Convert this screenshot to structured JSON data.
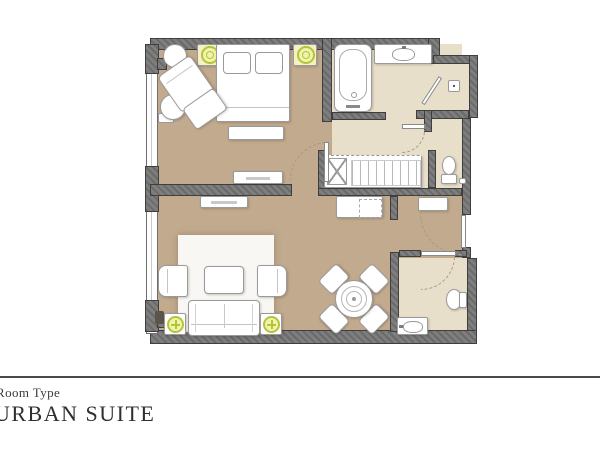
{
  "footer": {
    "label": "Room Type",
    "room_name": "URBAN SUITE"
  },
  "palette": {
    "wall": "#767676",
    "wall_edge": "#3e3e3e",
    "floor_main": "#c2aa8e",
    "floor_bath": "#e8dfcb",
    "furniture_line": "#9a9a9a",
    "lamp_glow": "#f0f3ae",
    "lamp_ring": "#b5c437",
    "nightstand_fill": "#f4f1c6",
    "arc": "#a89a82",
    "rule": "#4a4a4a",
    "footer_text": "#3c3c40"
  },
  "fixtures": [
    "double-bed",
    "pillows",
    "bed-bench",
    "nightstand-lamps",
    "armchair",
    "ottoman",
    "round-side-tables",
    "tv-console",
    "bathtub",
    "vanity-sink",
    "shower-drain",
    "wc-toilet",
    "wardrobe-hangers",
    "minibar-cabinet",
    "hall-bench",
    "rug",
    "sofa",
    "lounge-chairs",
    "coffee-table",
    "lamp-side-tables",
    "dining-table",
    "dining-chairs",
    "powder-toilet",
    "powder-sink",
    "door-swings",
    "window-wall"
  ]
}
